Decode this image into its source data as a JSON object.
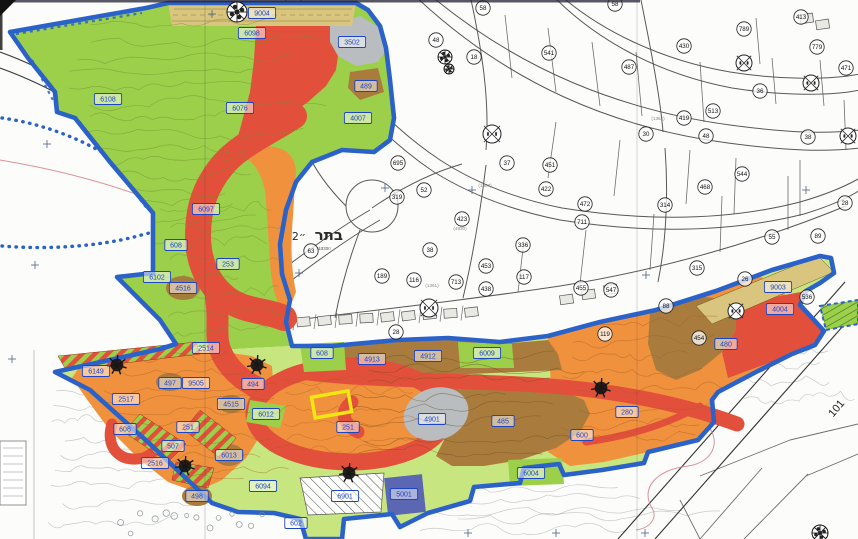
{
  "map": {
    "palette": {
      "paper": "#fcfcfa",
      "green": "#9ccf4a",
      "green_light": "#c8e67f",
      "orange": "#f0913d",
      "red": "#e2503b",
      "brown": "#a97c3e",
      "grey": "#b9bdc0",
      "tan": "#d9c57d",
      "purple": "#5b67b3",
      "boundary_blue": "#2b62c9",
      "label_blue": "#1c45c8",
      "yellow_highlight": "#f2e612",
      "line_dark": "#3c3c3c"
    },
    "place_label": {
      "main": "בתר",
      "secondary": "״2",
      "micro": "14330"
    },
    "rotated_road_label": {
      "text": "101"
    },
    "zone_labels": [
      {
        "x": 262,
        "y": 13,
        "t": "9004"
      },
      {
        "x": 252,
        "y": 33,
        "t": "6098"
      },
      {
        "x": 352,
        "y": 42,
        "t": "3502"
      },
      {
        "x": 366,
        "y": 86,
        "t": "489"
      },
      {
        "x": 358,
        "y": 118,
        "t": "4007"
      },
      {
        "x": 108,
        "y": 99,
        "t": "6108"
      },
      {
        "x": 240,
        "y": 108,
        "t": "6076"
      },
      {
        "x": 206,
        "y": 209,
        "t": "6097"
      },
      {
        "x": 176,
        "y": 245,
        "t": "608"
      },
      {
        "x": 228,
        "y": 264,
        "t": "253"
      },
      {
        "x": 157,
        "y": 277,
        "t": "6102"
      },
      {
        "x": 183,
        "y": 288,
        "t": "4516"
      },
      {
        "x": 206,
        "y": 348,
        "t": "2514"
      },
      {
        "x": 96,
        "y": 371,
        "t": "6149"
      },
      {
        "x": 170,
        "y": 383,
        "t": "497"
      },
      {
        "x": 196,
        "y": 383,
        "t": "9505"
      },
      {
        "x": 126,
        "y": 399,
        "t": "2517"
      },
      {
        "x": 253,
        "y": 384,
        "t": "494"
      },
      {
        "x": 231,
        "y": 404,
        "t": "4515"
      },
      {
        "x": 266,
        "y": 414,
        "t": "6012"
      },
      {
        "x": 188,
        "y": 427,
        "t": "251"
      },
      {
        "x": 125,
        "y": 429,
        "t": "608"
      },
      {
        "x": 173,
        "y": 446,
        "t": "507"
      },
      {
        "x": 155,
        "y": 463,
        "t": "2516"
      },
      {
        "x": 229,
        "y": 455,
        "t": "6013"
      },
      {
        "x": 263,
        "y": 486,
        "t": "6094"
      },
      {
        "x": 197,
        "y": 496,
        "t": "498"
      },
      {
        "x": 348,
        "y": 427,
        "t": "251"
      },
      {
        "x": 432,
        "y": 419,
        "t": "4901"
      },
      {
        "x": 503,
        "y": 421,
        "t": "485"
      },
      {
        "x": 345,
        "y": 496,
        "t": "6901"
      },
      {
        "x": 404,
        "y": 494,
        "t": "5001"
      },
      {
        "x": 296,
        "y": 523,
        "t": "602"
      },
      {
        "x": 322,
        "y": 353,
        "t": "608"
      },
      {
        "x": 372,
        "y": 359,
        "t": "4913"
      },
      {
        "x": 428,
        "y": 356,
        "t": "4912"
      },
      {
        "x": 487,
        "y": 353,
        "t": "6009"
      },
      {
        "x": 531,
        "y": 473,
        "t": "6004"
      },
      {
        "x": 778,
        "y": 287,
        "t": "9003"
      },
      {
        "x": 780,
        "y": 309,
        "t": "4004"
      },
      {
        "x": 726,
        "y": 344,
        "t": "480"
      },
      {
        "x": 627,
        "y": 412,
        "t": "280"
      },
      {
        "x": 582,
        "y": 435,
        "t": "600"
      }
    ],
    "parcel_numbers": [
      {
        "x": 483,
        "y": 8,
        "t": "58"
      },
      {
        "x": 615,
        "y": 4,
        "t": "58"
      },
      {
        "x": 436,
        "y": 40,
        "t": "48"
      },
      {
        "x": 474,
        "y": 57,
        "t": "18"
      },
      {
        "x": 549,
        "y": 53,
        "t": "541"
      },
      {
        "x": 398,
        "y": 163,
        "t": "695"
      },
      {
        "x": 397,
        "y": 197,
        "t": "319"
      },
      {
        "x": 424,
        "y": 190,
        "t": "52"
      },
      {
        "x": 311,
        "y": 251,
        "t": "63"
      },
      {
        "x": 462,
        "y": 219,
        "t": "423"
      },
      {
        "x": 430,
        "y": 250,
        "t": "38"
      },
      {
        "x": 523,
        "y": 245,
        "t": "336"
      },
      {
        "x": 486,
        "y": 266,
        "t": "453"
      },
      {
        "x": 456,
        "y": 282,
        "t": "713"
      },
      {
        "x": 414,
        "y": 280,
        "t": "116"
      },
      {
        "x": 524,
        "y": 277,
        "t": "117"
      },
      {
        "x": 486,
        "y": 289,
        "t": "438"
      },
      {
        "x": 507,
        "y": 163,
        "t": "37"
      },
      {
        "x": 550,
        "y": 165,
        "t": "451"
      },
      {
        "x": 546,
        "y": 189,
        "t": "422"
      },
      {
        "x": 396,
        "y": 332,
        "t": "28"
      },
      {
        "x": 629,
        "y": 67,
        "t": "487"
      },
      {
        "x": 684,
        "y": 46,
        "t": "430"
      },
      {
        "x": 744,
        "y": 29,
        "t": "789"
      },
      {
        "x": 801,
        "y": 17,
        "t": "413"
      },
      {
        "x": 817,
        "y": 47,
        "t": "779"
      },
      {
        "x": 846,
        "y": 68,
        "t": "471"
      },
      {
        "x": 760,
        "y": 91,
        "t": "36"
      },
      {
        "x": 713,
        "y": 111,
        "t": "513"
      },
      {
        "x": 684,
        "y": 118,
        "t": "419"
      },
      {
        "x": 706,
        "y": 136,
        "t": "48"
      },
      {
        "x": 646,
        "y": 134,
        "t": "30"
      },
      {
        "x": 808,
        "y": 137,
        "t": "38"
      },
      {
        "x": 742,
        "y": 174,
        "t": "544"
      },
      {
        "x": 585,
        "y": 204,
        "t": "472"
      },
      {
        "x": 582,
        "y": 222,
        "t": "711"
      },
      {
        "x": 665,
        "y": 205,
        "t": "314"
      },
      {
        "x": 705,
        "y": 187,
        "t": "468"
      },
      {
        "x": 772,
        "y": 237,
        "t": "55"
      },
      {
        "x": 697,
        "y": 268,
        "t": "315"
      },
      {
        "x": 581,
        "y": 288,
        "t": "455"
      },
      {
        "x": 611,
        "y": 290,
        "t": "547"
      },
      {
        "x": 666,
        "y": 306,
        "t": "88"
      },
      {
        "x": 745,
        "y": 279,
        "t": "26"
      },
      {
        "x": 699,
        "y": 338,
        "t": "454"
      },
      {
        "x": 605,
        "y": 334,
        "t": "119"
      },
      {
        "x": 807,
        "y": 297,
        "t": "536"
      },
      {
        "x": 818,
        "y": 236,
        "t": "89"
      },
      {
        "x": 845,
        "y": 203,
        "t": "28"
      },
      {
        "x": 382,
        "y": 276,
        "t": "189"
      }
    ],
    "micro_texts": [
      {
        "x": 322,
        "y": 250,
        "t": "14330"
      },
      {
        "x": 485,
        "y": 187,
        "t": "(1367)"
      },
      {
        "x": 460,
        "y": 230,
        "t": "(4930)"
      },
      {
        "x": 432,
        "y": 287,
        "t": "(1361)"
      },
      {
        "x": 658,
        "y": 120,
        "t": "(1364)"
      }
    ],
    "symbols": [
      {
        "t": "rosette",
        "x": 237,
        "y": 12,
        "r": 10
      },
      {
        "t": "rosette",
        "x": 445,
        "y": 57,
        "r": 7
      },
      {
        "t": "rosette",
        "x": 449,
        "y": 69,
        "r": 5
      },
      {
        "t": "survey",
        "x": 492,
        "y": 134,
        "r": 9
      },
      {
        "t": "survey",
        "x": 744,
        "y": 63,
        "r": 8
      },
      {
        "t": "survey",
        "x": 811,
        "y": 83,
        "r": 8
      },
      {
        "t": "survey",
        "x": 848,
        "y": 136,
        "r": 8
      },
      {
        "t": "survey",
        "x": 429,
        "y": 308,
        "r": 9
      },
      {
        "t": "survey",
        "x": 736,
        "y": 311,
        "r": 8
      },
      {
        "t": "tree",
        "x": 117,
        "y": 365,
        "r": 8
      },
      {
        "t": "tree",
        "x": 257,
        "y": 365,
        "r": 8
      },
      {
        "t": "tree",
        "x": 185,
        "y": 466,
        "r": 8
      },
      {
        "t": "tree",
        "x": 349,
        "y": 473,
        "r": 8
      },
      {
        "t": "tree",
        "x": 601,
        "y": 388,
        "r": 8
      },
      {
        "t": "rosette",
        "x": 820,
        "y": 533,
        "r": 8
      }
    ],
    "grid_crosses": [
      {
        "x": 212,
        "y": 14
      },
      {
        "x": 47,
        "y": 144
      },
      {
        "x": 35,
        "y": 265
      },
      {
        "x": 299,
        "y": 273
      },
      {
        "x": 385,
        "y": 188
      },
      {
        "x": 472,
        "y": 190
      },
      {
        "x": 646,
        "y": 275
      },
      {
        "x": 806,
        "y": 190
      },
      {
        "x": 12,
        "y": 359
      },
      {
        "x": 468,
        "y": 533
      },
      {
        "x": 556,
        "y": 533
      },
      {
        "x": 645,
        "y": 533
      }
    ]
  }
}
